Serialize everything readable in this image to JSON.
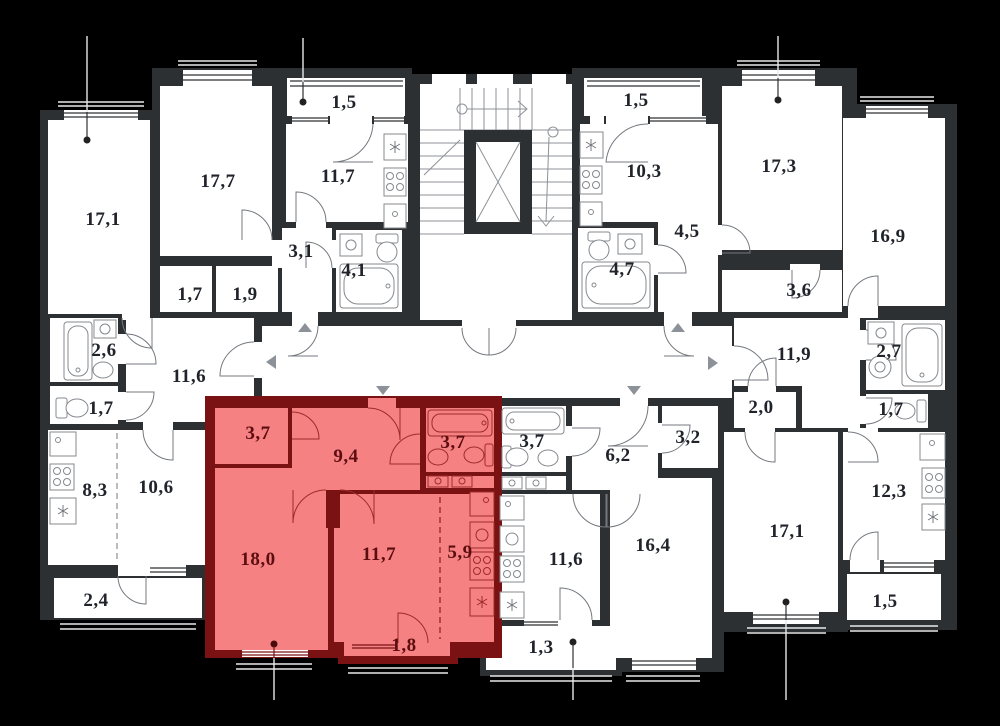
{
  "plan": {
    "kind": "apartment-floor-plan",
    "background": "#000000",
    "wall_color": "#2d3033",
    "room_fill": "#ffffff",
    "highlight_fill": "#f58182",
    "highlight_wall": "#7a1214",
    "label_color": "#20232a",
    "highlight_label_color": "#5c0d10"
  },
  "highlighted_apartment": {
    "room_areas": [
      "3,7",
      "9,4",
      "3,7",
      "18,0",
      "11,7",
      "5,9",
      "1,8"
    ]
  },
  "rooms": [
    {
      "area": "17,1",
      "x": 103,
      "y": 220,
      "highlighted": false
    },
    {
      "area": "17,7",
      "x": 218,
      "y": 182,
      "highlighted": false
    },
    {
      "area": "1,5",
      "x": 344,
      "y": 103,
      "highlighted": false
    },
    {
      "area": "11,7",
      "x": 338,
      "y": 177,
      "highlighted": false
    },
    {
      "area": "3,1",
      "x": 301,
      "y": 252,
      "highlighted": false
    },
    {
      "area": "4,1",
      "x": 354,
      "y": 271,
      "highlighted": false
    },
    {
      "area": "1,7",
      "x": 190,
      "y": 295,
      "highlighted": false
    },
    {
      "area": "1,9",
      "x": 245,
      "y": 295,
      "highlighted": false
    },
    {
      "area": "2,6",
      "x": 104,
      "y": 351,
      "highlighted": false
    },
    {
      "area": "1,5",
      "x": 636,
      "y": 101,
      "highlighted": false
    },
    {
      "area": "10,3",
      "x": 644,
      "y": 172,
      "highlighted": false
    },
    {
      "area": "17,3",
      "x": 779,
      "y": 167,
      "highlighted": false
    },
    {
      "area": "16,9",
      "x": 888,
      "y": 237,
      "highlighted": false
    },
    {
      "area": "4,5",
      "x": 687,
      "y": 232,
      "highlighted": false
    },
    {
      "area": "4,7",
      "x": 622,
      "y": 270,
      "highlighted": false
    },
    {
      "area": "3,6",
      "x": 799,
      "y": 291,
      "highlighted": false
    },
    {
      "area": "11,6",
      "x": 189,
      "y": 377,
      "highlighted": false
    },
    {
      "area": "11,9",
      "x": 794,
      "y": 355,
      "highlighted": false
    },
    {
      "area": "1,7",
      "x": 101,
      "y": 409,
      "highlighted": false
    },
    {
      "area": "8,3",
      "x": 95,
      "y": 491,
      "highlighted": false
    },
    {
      "area": "10,6",
      "x": 156,
      "y": 488,
      "highlighted": false
    },
    {
      "area": "2,4",
      "x": 96,
      "y": 601,
      "highlighted": false
    },
    {
      "area": "3,7",
      "x": 258,
      "y": 434,
      "highlighted": true
    },
    {
      "area": "9,4",
      "x": 346,
      "y": 457,
      "highlighted": true
    },
    {
      "area": "3,7",
      "x": 453,
      "y": 443,
      "highlighted": true
    },
    {
      "area": "18,0",
      "x": 258,
      "y": 560,
      "highlighted": true
    },
    {
      "area": "11,7",
      "x": 379,
      "y": 555,
      "highlighted": true
    },
    {
      "area": "5,9",
      "x": 460,
      "y": 553,
      "highlighted": true
    },
    {
      "area": "1,8",
      "x": 404,
      "y": 646,
      "highlighted": true
    },
    {
      "area": "3,7",
      "x": 532,
      "y": 442,
      "highlighted": false
    },
    {
      "area": "6,2",
      "x": 618,
      "y": 456,
      "highlighted": false
    },
    {
      "area": "3,2",
      "x": 688,
      "y": 438,
      "highlighted": false
    },
    {
      "area": "2,0",
      "x": 761,
      "y": 408,
      "highlighted": false
    },
    {
      "area": "1,7",
      "x": 891,
      "y": 410,
      "highlighted": false
    },
    {
      "area": "2,7",
      "x": 889,
      "y": 352,
      "highlighted": false
    },
    {
      "area": "12,3",
      "x": 889,
      "y": 492,
      "highlighted": false
    },
    {
      "area": "11,6",
      "x": 566,
      "y": 560,
      "highlighted": false
    },
    {
      "area": "16,4",
      "x": 653,
      "y": 546,
      "highlighted": false
    },
    {
      "area": "17,1",
      "x": 787,
      "y": 532,
      "highlighted": false
    },
    {
      "area": "1,3",
      "x": 541,
      "y": 648,
      "highlighted": false
    },
    {
      "area": "1,5",
      "x": 885,
      "y": 602,
      "highlighted": false
    }
  ]
}
